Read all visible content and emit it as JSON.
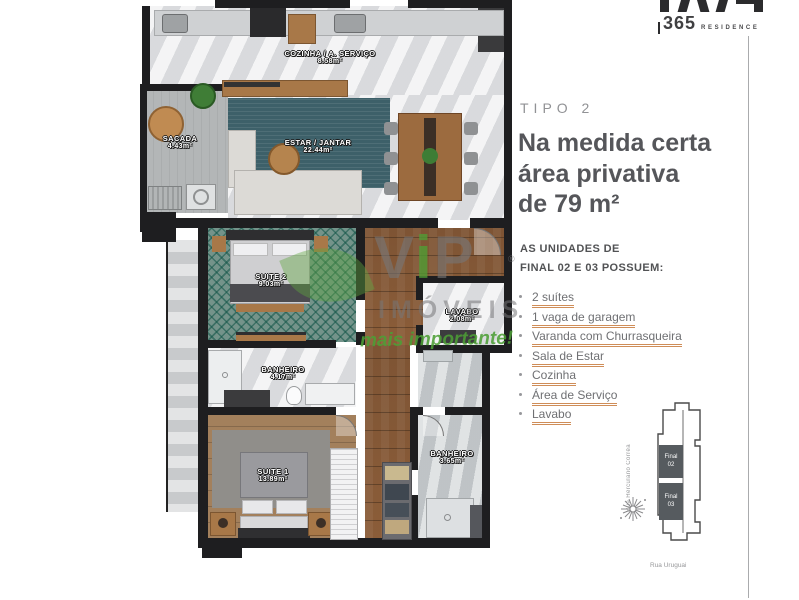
{
  "logo": {
    "number": "365",
    "name": "RESIDENCE"
  },
  "panel": {
    "tipo": "TIPO 2",
    "headline_lines": [
      "Na medida certa",
      "área privativa",
      "de 79 m²"
    ],
    "subheading_lines": [
      "AS UNIDADES DE",
      "FINAL 02 E 03 POSSUEM:"
    ],
    "features": [
      "2 suítes",
      "1 vaga de garagem",
      "Varanda com Churrasqueira",
      "Sala de Estar",
      "Cozinha",
      "Área de Serviço",
      "Lavabo"
    ],
    "accent_color": "#cf8d58"
  },
  "plan": {
    "rooms": [
      {
        "name": "COZINHA / A. SERVIÇO",
        "area": "8.58m²"
      },
      {
        "name": "SACADA",
        "area": "4.43m²"
      },
      {
        "name": "ESTAR / JANTAR",
        "area": "22.44m²"
      },
      {
        "name": "SUITE 2",
        "area": "9.03m²"
      },
      {
        "name": "LAVABO",
        "area": "2.08m²"
      },
      {
        "name": "BANHEIRO",
        "area": "4.17m²"
      },
      {
        "name": "SUITE 1",
        "area": "13.89m²"
      },
      {
        "name": "BANHEIRO",
        "area": "3.65m²"
      }
    ],
    "wall_color": "#1e1e20"
  },
  "watermark": {
    "brand_letters": [
      "V",
      "i",
      "P"
    ],
    "sub": "IMÓVEIS",
    "tagline": "mais importante!",
    "reg": "®",
    "green": "#509e34"
  },
  "sitemap": {
    "unit_top_lines": [
      "Final",
      "02"
    ],
    "unit_bottom_lines": [
      "Final",
      "03"
    ],
    "street_left": "Rua Herculano Corrêa",
    "street_bottom": "Rua Uruguai"
  }
}
